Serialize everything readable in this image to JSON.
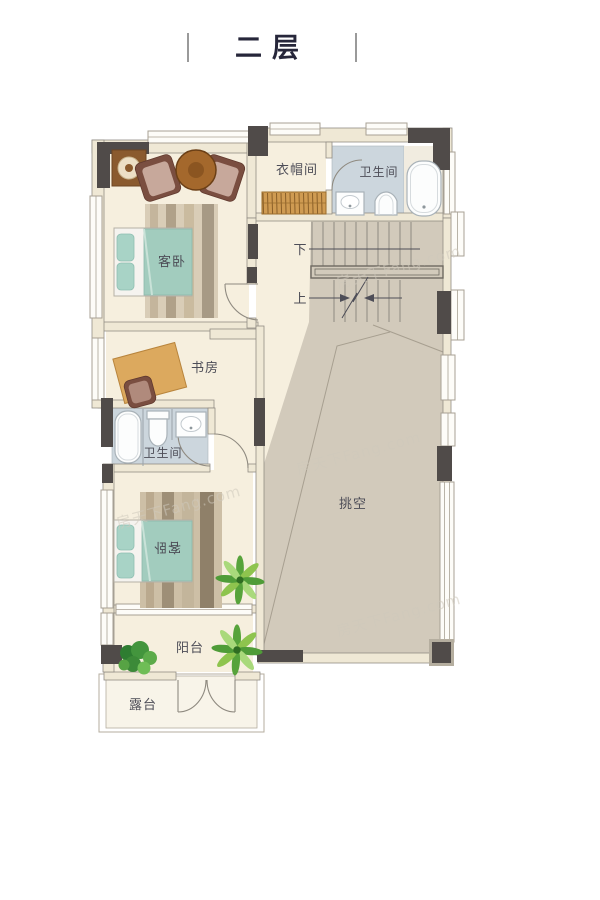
{
  "title": {
    "text": "二层"
  },
  "rooms": {
    "bedroom_top": {
      "label": "客卧"
    },
    "cloakroom": {
      "label": "衣帽间"
    },
    "bathroom_top": {
      "label": "卫生间"
    },
    "study": {
      "label": "书房"
    },
    "bathroom_middle": {
      "label": "卫生间"
    },
    "bedroom_bottom": {
      "label": "客卧"
    },
    "void": {
      "label": "挑空"
    },
    "balcony": {
      "label": "阳台"
    },
    "terrace": {
      "label": "露台"
    }
  },
  "stairs": {
    "down_label": "下",
    "up_label": "上"
  },
  "watermark": {
    "text": "房天下Fang.com"
  },
  "colors": {
    "floor": "#f6efde",
    "floor_light": "#f1ece0",
    "wall_fill": "#efe8d5",
    "wall_line": "#918c84",
    "wall_dark": "#504b49",
    "void_floor": "#d2cabb",
    "bath_floor": "#ccd6dd",
    "wardrobe_wood": "#cf9b52",
    "desk_wood": "#dca95e",
    "bed_blanket": "#a2ccbe",
    "pillow": "#a8d3c6",
    "chair_dark": "#7a4e40",
    "chair_cushion": "#c7a89b",
    "table_wood": "#a4682c",
    "plant_green": "#57a33b",
    "label_text": "#4d4d57"
  }
}
